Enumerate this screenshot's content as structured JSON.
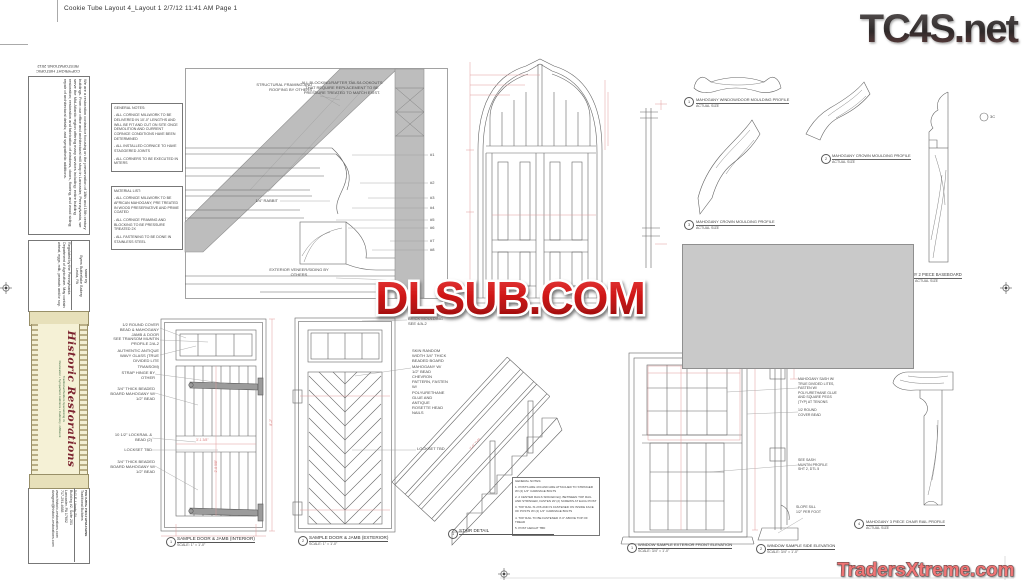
{
  "page": {
    "header": "Cookie Tube Layout 4_Layout 1  2/7/12  11:41 AM  Page 1"
  },
  "watermarks": {
    "tc4s": "TC4S.net",
    "dlsub": "DLSUB.COM",
    "traders": "TradersXtreme.com"
  },
  "colors": {
    "dlsub_red": "#c41515",
    "traders_red": "#ee6a6a",
    "logo_dark": "#332f2f",
    "dim_red": "#e09b9b",
    "line_gray": "#666666",
    "roof_gray": "#bdbdbd",
    "censor_gray": "#c9c9c9",
    "banner_cream": "#f5f1d6",
    "brand_red": "#7c2430",
    "brand_green": "#3d6b40"
  },
  "tube": {
    "copyright_line1": "COPYRIGHT HISTORIC",
    "copyright_line2": "RESTORATIONS 2012",
    "about": "We are a restoration contractor focusing on the preservation of 18th and 19th century buildings. From our office and architectural mill shop in Lancaster, Pennsylvania, we serve the Mid-Atlantic region offering many services including: entire building restoration; restoration and fabrication of windows, doors, flooring, and wood siding; repair of architectural details; and sympathetic additions.",
    "made_by": "Made by",
    "bakery": "Byers Butterflake Bakery",
    "bakery_city": "Leola, PA",
    "regulated": "Regulated by the Pennsylvania Department of Agriculture. May contain wheat, eggs, milk, peanuts and/or soy.",
    "brand_title": "Historic Restorations",
    "brand_sub1": "Traditional Builders Specializing in:",
    "brand_sub2": "Restoration • Sympathetic Additions • Cabinetry • Millwork",
    "contact_name": "HISTORIC RESTORATIONS",
    "contact_tag": "Traditional Builders",
    "addr1": "541 E. Liberty St.",
    "addr2": "Building #2, Suite 201",
    "addr3": "Lancaster, PA 17602",
    "phone": "717-291-4688",
    "web": "www.historic-restorations.com",
    "email": "dwagner@historic-restorations.com"
  },
  "cornice": {
    "general_notes_title": "GENERAL NOTES:",
    "general_notes": [
      "- ALL CORNICE MILLWORK TO BE DELIVERED IN 10'-0\" LENGTHS AND WILL BE FIT AND CUT ON SITE ONCE DEMOLITION AND CURRENT CORNICE CONDITIONS HAVE BEEN DETERMINED",
      "- ALL INSTALLED CORNICE TO HAVE STAGGERED JOINTS",
      "- ALL CORNERS TO BE EXECUTED IN MITERS"
    ],
    "material_list_title": "MATERIAL LIST:",
    "material_list": [
      "- ALL CORNICE MILLWORK TO BE AFRICAN MAHOGANY, PRE TREATED IN WOOD PRESERVATIVE AND PRIME COATED",
      "- ALL CORNICE FRAMING AND BLOCKING TO BE PRESSURE TREATED 2X",
      "- ALL FASTENING TO BE DONE IN STAINLESS STEEL"
    ],
    "note_blocking": "ALL BLOCKING/RAFTER TAILS/LOOKOUTS THAT REQUIRE REPLACEMENT TO BE PRESSURE TREATED TO MATCH EXIST.",
    "note_structural": "STRUCTURAL FRAMING AND ROOFING BY OTHERS",
    "note_rabbit": "1/4\" RABBIT",
    "note_exterior": "EXTERIOR VENEER/SIDING BY OTHERS",
    "callouts": [
      "#1",
      "#2",
      "#3",
      "#4",
      "#5",
      "#6",
      "#7",
      "#8"
    ]
  },
  "profiles": {
    "p1": {
      "num": "1",
      "label": "MAHOGANY WINDOW/DOOR MOULDING PROFILE",
      "sub": "ACTUAL SIZE"
    },
    "p2": {
      "num": "2",
      "label": "MAHOGANY CROWN MOULDING PROFILE",
      "sub": "ACTUAL SIZE"
    },
    "p3": {
      "num": "3",
      "label": "MAHOGANY CROWN MOULDING PROFILE",
      "sub": "ACTUAL SIZE"
    },
    "baseboard": {
      "label": "MAHOGANY 2 PIECE BASEBOARD",
      "sub": "ACTUAL SIZE",
      "marker": "3C"
    },
    "chair": {
      "num": "4",
      "label": "MAHOGANY 3 PIECE CHAIR RAIL PROFILE",
      "sub": "ACTUAL SIZE"
    }
  },
  "door1": {
    "callouts": [
      "1/2 ROUND COVER BEAD & MAHOGANY JAMB & DOOR",
      "SEE TRANSOM MUNTIN PROFILE 2/A-2",
      "AUTHENTIC ANTIQUE WAVY GLASS (TRUE DIVIDED LITE TRANSOM)",
      "STRAP HINGE BY OTHER",
      "3/4\" THICK BEADED BOARD MAHOGANY W/ 1/2\" BEAD",
      "10 1/2\" LOCKRAIL & BEAD (2)",
      "LOCKSET TBD",
      "3/4\" THICK BEADED BOARD MAHOGANY W/ 1/2\" BEAD"
    ],
    "dim_width": "3'-1 3/8\"",
    "dim_inner": "2'-8 5/8\"",
    "dim_height": "8'-2\"",
    "caption": {
      "num": "1",
      "text": "SAMPLE DOOR & JAMB (INTERIOR)",
      "scale": "SCALE: 1\" = 1'-0\""
    }
  },
  "door2": {
    "brick": "BRICK MOULDING SEE 4/A-2",
    "skin": "SKIN RANDOM WIDTH 3/4\" THICK BEADED BOARD MAHOGANY W/ 1/2\" BEAD CHEVRON PATTERN, FASTEN W/ POLYURETHANE GLUE AND ANTIQUE ROSETTE HEAD NAILS",
    "lockset": "LOCKSET TBD",
    "caption": {
      "num": "2",
      "text": "SAMPLE DOOR & JAMB (EXTERIOR)",
      "scale": "SCALE: 1\" = 1'-0\""
    }
  },
  "stair": {
    "notes_title": "GENERAL NOTES:",
    "notes": [
      "1. POSTS ARE 4X4 AND ARE ATTACHED TO STRINGER W/ (2) 1/2\" CARRIAGE BOLTS",
      "2. 2 CENTER RAILS SPACED EQ. BETWEEN TOP RAIL AND STRINGER, FASTEN W/ (2) SCREWS AT EACH POST",
      "3. TOP RAIL IS 2X6 AND IS FASTENED ON INSIDE FACE OF POSTS W/ (2) 1/2\" CARRIAGE BOLTS",
      "4. TOP RAIL TO BE FASTENED 3'-0\" ABOVE TOP OF TREAD",
      "5. POST HEIGHT TBD"
    ],
    "dim": "3'-0\" TYP",
    "caption": {
      "num": "1",
      "text": "STAIR DETAIL"
    }
  },
  "window": {
    "c1": "MAHOGANY SASH W/ TRUE DIVIDED LITES, FASTEN W/ POLYURETHANE GLUE AND SQUARE PEGS (TYP) AT TENONS",
    "c2": "1/2 ROUND COVER BEAD",
    "c3": "SEE SASH MUNTIN PROFILE SHT 2, DTL 5",
    "c4": "SLOPE SILL 1/2\" PER FOOT",
    "cap_front": {
      "num": "1",
      "text": "WINDOW SAMPLE EXTERIOR FRONT ELEVATION",
      "scale": "SCALE: 3/4\" = 1'-0\""
    },
    "cap_side": {
      "num": "2",
      "text": "WINDOW SAMPLE SIDE ELEVATION",
      "scale": "SCALE: 3/4\" = 1'-0\""
    }
  }
}
